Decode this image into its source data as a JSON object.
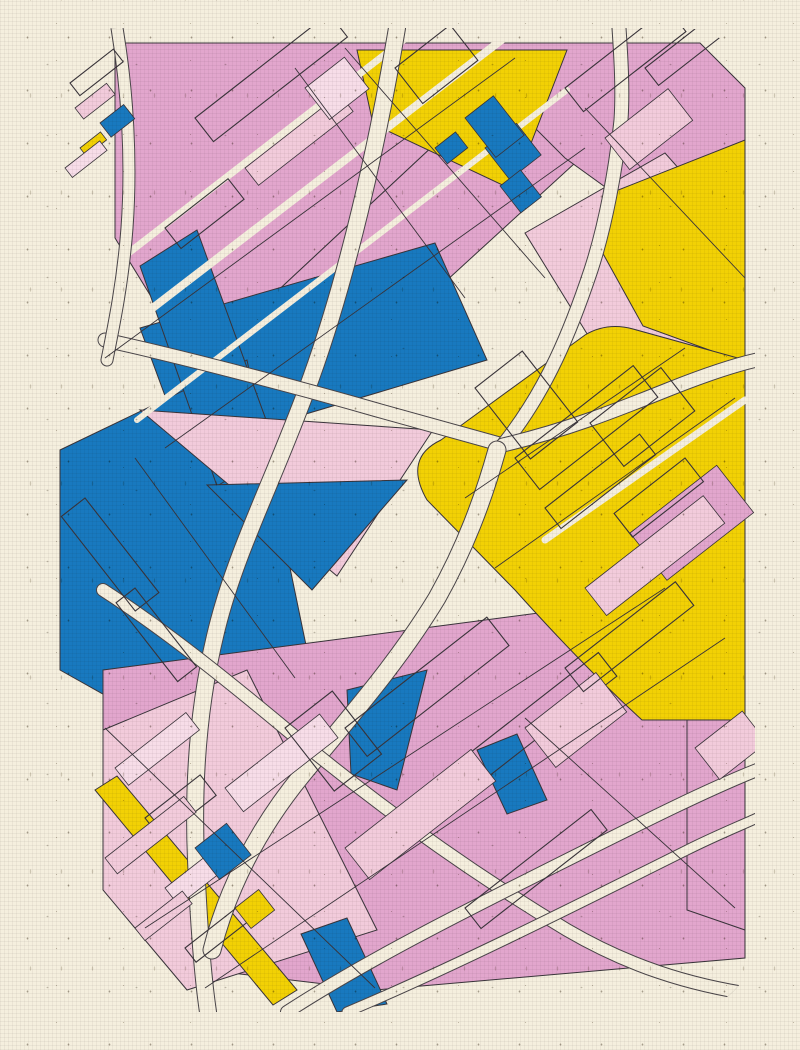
{
  "artwork": {
    "title_semantic": "generative-map-poster",
    "palette": {
      "paper": "#f5efde",
      "pink": "#e2a6cd",
      "pinkLight": "#f2cbdb",
      "pinkPale": "#f7dde8",
      "blue": "#1879bf",
      "yellow": "#f2d105",
      "ink": "#39343a",
      "roadEdge": "#4a4549"
    },
    "canvas": {
      "width": 800,
      "height": 1050,
      "map_left": 45,
      "map_top": 28,
      "map_width": 710,
      "map_height": 984,
      "corner_radius": 72
    },
    "layers": {
      "regions": [
        {
          "name": "tl-pink-field",
          "fill": "pink",
          "points": "70,15 450,15 450,60 150,340 70,210"
        },
        {
          "name": "tl-pink-lower",
          "fill": "pink",
          "points": "150,340 450,60 530,135 235,405"
        },
        {
          "name": "tr-pink-field",
          "fill": "pink",
          "points": "450,15 655,15 700,60 700,260 520,130 450,60"
        },
        {
          "name": "tr-lightpink",
          "fill": "pinkLight",
          "points": "480,205 620,125 700,215 700,335 560,335"
        },
        {
          "name": "tr-yellow",
          "fill": "yellow",
          "points": "558,168 700,112 700,335 598,298 556,222"
        },
        {
          "name": "tc-yellow-tri",
          "fill": "yellow",
          "points": "312,22 522,22 468,162 328,96"
        },
        {
          "name": "ml-blue-band",
          "fill": "blue",
          "points": "95,300 390,215 442,332 140,422"
        },
        {
          "name": "l-blue-col",
          "fill": "blue",
          "points": "15,422 202,332 262,622 122,702 15,642"
        },
        {
          "name": "l-blue-par",
          "fill": "blue",
          "points": "95,238 152,202 232,422 172,458"
        },
        {
          "name": "c-lightpink-tri",
          "fill": "pinkLight",
          "points": "95,382 388,402 292,548"
        },
        {
          "name": "c-blue-tri",
          "fill": "blue",
          "points": "162,457 362,452 267,562"
        },
        {
          "name": "b-pink-zone",
          "fill": "pink",
          "points": "58,642 700,558 700,930 330,962 162,942 58,762"
        },
        {
          "name": "bl-lightpink",
          "fill": "pinkLight",
          "points": "58,702 202,642 332,902 142,962 58,862"
        },
        {
          "name": "bl-yellow-stripe",
          "fill": "yellow",
          "points": "50,762 72,748 252,962 228,977"
        },
        {
          "name": "b-blue-wedge",
          "fill": "blue",
          "points": "302,662 382,642 352,762 306,746"
        },
        {
          "name": "b-blue-strip",
          "fill": "blue",
          "points": "256,906 302,890 342,976 292,984"
        },
        {
          "name": "b-blue-small",
          "fill": "blue",
          "points": "432,722 472,706 502,772 462,786"
        },
        {
          "name": "br-pink-col",
          "fill": "pink",
          "points": "642,692 700,662 700,902 642,882"
        }
      ],
      "region_paths": [
        {
          "name": "r-yellow-field",
          "fill": "yellow",
          "d": "M 382,472 Q 358,430 396,412 L 540,307 Q 562,294 588,301 L 700,332 L 700,692 L 597,692 Q 540,640 470,562 Z"
        }
      ],
      "streets": [
        {
          "d": "M 40,332 L 472,0",
          "w": 8
        },
        {
          "d": "M 92,392 L 522,62",
          "w": 6
        },
        {
          "d": "M 10,282 L 392,-14",
          "w": 7
        },
        {
          "d": "M 500,512 L 700,372",
          "w": 7
        }
      ],
      "roads": [
        {
          "d": "M 352,0 C 332,120 302,250 266,350 C 230,450 192,520 172,600 C 152,680 148,760 151,832 C 154,902 158,950 163,984",
          "w": 16
        },
        {
          "d": "M 60,312 C 150,332 262,362 332,382 C 382,396 422,407 458,417",
          "w": 13
        },
        {
          "d": "M 458,417 C 502,362 526,302 546,242 C 561,196 571,140 576,92 C 578,62 576,30 574,0",
          "w": 13
        },
        {
          "d": "M 458,417 C 522,402 572,382 622,362 C 662,346 690,337 712,332",
          "w": 13
        },
        {
          "d": "M 452,422 C 438,472 420,520 392,570 C 352,636 302,692 257,747 C 212,802 182,862 167,922",
          "w": 17
        },
        {
          "d": "M 58,562 C 120,602 182,652 242,702 C 332,777 422,842 522,902 C 582,937 642,957 712,967",
          "w": 12
        },
        {
          "d": "M 242,984 C 322,932 422,882 522,832 C 602,792 662,762 712,742",
          "w": 12
        },
        {
          "d": "M 302,984 C 402,942 522,882 642,822 C 672,807 697,797 712,790",
          "w": 9
        },
        {
          "d": "M 72,0 C 82,60 87,130 82,200 C 78,252 70,292 62,332",
          "w": 11
        }
      ],
      "details": [
        {
          "x": 470,
          "y": 430,
          "w": 150,
          "h": 40,
          "r": -38,
          "f": "none"
        },
        {
          "x": 500,
          "y": 480,
          "w": 120,
          "h": 26,
          "r": -38,
          "f": "none"
        },
        {
          "x": 545,
          "y": 395,
          "w": 90,
          "h": 55,
          "r": -38,
          "f": "none"
        },
        {
          "x": 430,
          "y": 360,
          "w": 60,
          "h": 90,
          "r": -38,
          "f": "none"
        },
        {
          "x": 585,
          "y": 505,
          "w": 110,
          "h": 60,
          "r": -38,
          "f": "pink"
        },
        {
          "x": 540,
          "y": 560,
          "w": 150,
          "h": 35,
          "r": -38,
          "f": "pinkLight"
        },
        {
          "x": 520,
          "y": 60,
          "w": 130,
          "h": 30,
          "r": -38,
          "f": "none"
        },
        {
          "x": 560,
          "y": 110,
          "w": 80,
          "h": 40,
          "r": -38,
          "f": "pinkLight"
        },
        {
          "x": 600,
          "y": 40,
          "w": 90,
          "h": 22,
          "r": -38,
          "f": "none"
        },
        {
          "x": 440,
          "y": 120,
          "w": 40,
          "h": 40,
          "r": -38,
          "f": "blue"
        },
        {
          "x": 455,
          "y": 158,
          "w": 26,
          "h": 34,
          "r": -38,
          "f": "blue"
        },
        {
          "x": 350,
          "y": 40,
          "w": 70,
          "h": 45,
          "r": -38,
          "f": "none"
        },
        {
          "x": 420,
          "y": 90,
          "w": 36,
          "h": 50,
          "r": -38,
          "f": "blue"
        },
        {
          "x": 390,
          "y": 120,
          "w": 26,
          "h": 20,
          "r": -38,
          "f": "blue"
        },
        {
          "x": 150,
          "y": 90,
          "w": 170,
          "h": 30,
          "r": -38,
          "f": "none"
        },
        {
          "x": 200,
          "y": 140,
          "w": 120,
          "h": 22,
          "r": -38,
          "f": "pinkLight"
        },
        {
          "x": 120,
          "y": 200,
          "w": 80,
          "h": 26,
          "r": -38,
          "f": "none"
        },
        {
          "x": 260,
          "y": 60,
          "w": 50,
          "h": 40,
          "r": -38,
          "f": "pinkPale"
        },
        {
          "x": 25,
          "y": 55,
          "w": 55,
          "h": 16,
          "r": -38,
          "f": "none"
        },
        {
          "x": 30,
          "y": 80,
          "w": 40,
          "h": 14,
          "r": -38,
          "f": "pinkLight"
        },
        {
          "x": 55,
          "y": 95,
          "w": 30,
          "h": 18,
          "r": -38,
          "f": "blue"
        },
        {
          "x": 35,
          "y": 120,
          "w": 26,
          "h": 10,
          "r": -38,
          "f": "yellow"
        },
        {
          "x": 20,
          "y": 140,
          "w": 44,
          "h": 12,
          "r": -38,
          "f": "pinkPale"
        },
        {
          "x": 40,
          "y": 470,
          "w": 120,
          "h": 30,
          "r": 52,
          "f": "none"
        },
        {
          "x": 90,
          "y": 560,
          "w": 100,
          "h": 24,
          "r": 52,
          "f": "none"
        },
        {
          "x": 300,
          "y": 700,
          "w": 180,
          "h": 36,
          "r": -38,
          "f": "none"
        },
        {
          "x": 380,
          "y": 760,
          "w": 220,
          "h": 30,
          "r": -38,
          "f": "none"
        },
        {
          "x": 300,
          "y": 820,
          "w": 160,
          "h": 40,
          "r": -38,
          "f": "pinkLight"
        },
        {
          "x": 480,
          "y": 700,
          "w": 90,
          "h": 50,
          "r": -38,
          "f": "pinkLight"
        },
        {
          "x": 520,
          "y": 640,
          "w": 140,
          "h": 30,
          "r": -38,
          "f": "none"
        },
        {
          "x": 420,
          "y": 880,
          "w": 160,
          "h": 26,
          "r": -38,
          "f": "none"
        },
        {
          "x": 180,
          "y": 760,
          "w": 120,
          "h": 30,
          "r": -38,
          "f": "pinkPale"
        },
        {
          "x": 240,
          "y": 700,
          "w": 60,
          "h": 80,
          "r": -38,
          "f": "none"
        },
        {
          "x": 70,
          "y": 740,
          "w": 90,
          "h": 22,
          "r": -38,
          "f": "pinkPale"
        },
        {
          "x": 100,
          "y": 790,
          "w": 70,
          "h": 26,
          "r": -38,
          "f": "none"
        },
        {
          "x": 60,
          "y": 830,
          "w": 100,
          "h": 20,
          "r": -38,
          "f": "pinkLight"
        },
        {
          "x": 120,
          "y": 860,
          "w": 60,
          "h": 22,
          "r": -38,
          "f": "pinkPale"
        },
        {
          "x": 150,
          "y": 820,
          "w": 40,
          "h": 40,
          "r": -38,
          "f": "blue"
        },
        {
          "x": 90,
          "y": 900,
          "w": 60,
          "h": 16,
          "r": -38,
          "f": "pinkLight"
        },
        {
          "x": 140,
          "y": 920,
          "w": 80,
          "h": 18,
          "r": -38,
          "f": "none"
        },
        {
          "x": 190,
          "y": 880,
          "w": 30,
          "h": 26,
          "r": -38,
          "f": "yellow"
        },
        {
          "x": 640,
          "y": 430,
          "w": 30,
          "h": 90,
          "r": 52,
          "f": "none"
        },
        {
          "x": 650,
          "y": 720,
          "w": 60,
          "h": 40,
          "r": -38,
          "f": "pinkLight"
        }
      ],
      "lines": [
        {
          "x1": 60,
          "y1": 330,
          "x2": 470,
          "y2": 30
        },
        {
          "x1": 120,
          "y1": 420,
          "x2": 540,
          "y2": 120
        },
        {
          "x1": 250,
          "y1": 40,
          "x2": 420,
          "y2": 270
        },
        {
          "x1": 300,
          "y1": 20,
          "x2": 500,
          "y2": 250
        },
        {
          "x1": 420,
          "y1": 470,
          "x2": 640,
          "y2": 320
        },
        {
          "x1": 450,
          "y1": 540,
          "x2": 690,
          "y2": 370
        },
        {
          "x1": 100,
          "y1": 900,
          "x2": 620,
          "y2": 560
        },
        {
          "x1": 160,
          "y1": 960,
          "x2": 680,
          "y2": 610
        },
        {
          "x1": 60,
          "y1": 700,
          "x2": 330,
          "y2": 960
        },
        {
          "x1": 480,
          "y1": 690,
          "x2": 690,
          "y2": 880
        },
        {
          "x1": 540,
          "y1": 80,
          "x2": 700,
          "y2": 250
        },
        {
          "x1": 90,
          "y1": 430,
          "x2": 250,
          "y2": 650
        }
      ]
    }
  }
}
